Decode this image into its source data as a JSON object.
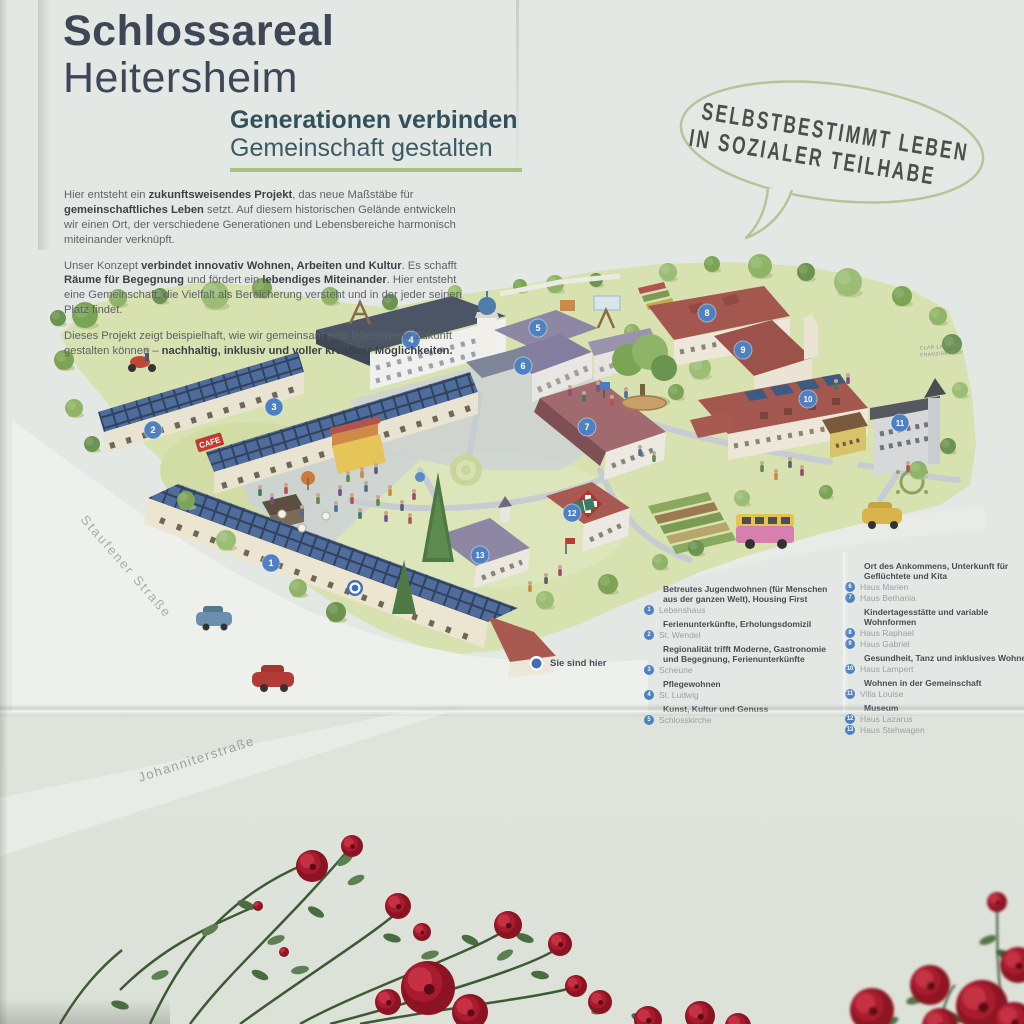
{
  "banner": {
    "title_line1": "Schlossareal",
    "title_line2": "Heitersheim",
    "subtitle_line1": "Generationen verbinden",
    "subtitle_line2": "Gemeinschaft gestalten",
    "bubble_line1": "SELBSTBESTIMMT LEBEN",
    "bubble_line2": "IN SOZIALER TEILHABE"
  },
  "intro": {
    "p1": {
      "s": [
        {
          "t": "Hier entsteht ein "
        },
        {
          "t": "zukunftsweisendes Projekt",
          "b": true
        },
        {
          "t": ", das neue Maßstäbe für "
        },
        {
          "t": "gemeinschaftliches Leben",
          "b": true
        },
        {
          "t": " setzt. Auf diesem historischen Gelände entwickeln wir einen Ort, der verschiedene Generationen und Lebensbereiche harmonisch miteinander verknüpft."
        }
      ]
    },
    "p2": {
      "s": [
        {
          "t": "Unser Konzept "
        },
        {
          "t": "verbindet innovativ Wohnen, Arbeiten und Kultur",
          "b": true
        },
        {
          "t": ". Es schafft "
        },
        {
          "t": "Räume für Begegnung",
          "b": true
        },
        {
          "t": " und fördert ein "
        },
        {
          "t": "lebendiges Miteinander",
          "b": true
        },
        {
          "t": ". Hier entsteht eine Gemeinschaft, die Vielfalt als Bereicherung versteht und in der jeder seinen Platz findet."
        }
      ]
    },
    "p3": {
      "s": [
        {
          "t": "Dieses Projekt zeigt beispielhaft, wie wir gemeinsam eine lebenswerte Zukunft gestalten können – "
        },
        {
          "t": "nachhaltig, inklusiv und voller kreativer Möglichkeiten.",
          "b": true
        }
      ]
    }
  },
  "map": {
    "cafe_sign": "CAFE",
    "street_left": "Staufener Straße",
    "street_bottom": "Johanniterstraße",
    "signature": "Clar Langen Franziskus",
    "you_are_here_label": "Sie sind hier",
    "markers": [
      {
        "n": "1",
        "x": 271,
        "y": 563
      },
      {
        "n": "2",
        "x": 153,
        "y": 430
      },
      {
        "n": "3",
        "x": 274,
        "y": 407
      },
      {
        "n": "4",
        "x": 411,
        "y": 340
      },
      {
        "n": "5",
        "x": 538,
        "y": 328
      },
      {
        "n": "6",
        "x": 523,
        "y": 366
      },
      {
        "n": "7",
        "x": 587,
        "y": 427
      },
      {
        "n": "8",
        "x": 707,
        "y": 313
      },
      {
        "n": "9",
        "x": 743,
        "y": 350
      },
      {
        "n": "10",
        "x": 808,
        "y": 399
      },
      {
        "n": "11",
        "x": 900,
        "y": 423
      },
      {
        "n": "12",
        "x": 572,
        "y": 513
      },
      {
        "n": "13",
        "x": 480,
        "y": 555
      }
    ],
    "you_are_here_pos": {
      "x": 355,
      "y": 588
    }
  },
  "legend": {
    "left": [
      {
        "title": "Betreutes Jugendwohnen (für Menschen aus der ganzen Welt), Housing First",
        "entries": [
          {
            "n": "1",
            "name": "Lebenshaus"
          }
        ]
      },
      {
        "title": "Ferienunterkünfte, Erholungsdomizil",
        "entries": [
          {
            "n": "2",
            "name": "St. Wendel"
          }
        ]
      },
      {
        "title": "Regionalität trifft Moderne, Gastronomie und Begegnung, Ferienunterkünfte",
        "entries": [
          {
            "n": "3",
            "name": "Scheune"
          }
        ]
      },
      {
        "title": "Pflegewohnen",
        "entries": [
          {
            "n": "4",
            "name": "St. Ludwig"
          }
        ]
      },
      {
        "title": "Kunst, Kultur und Genuss",
        "entries": [
          {
            "n": "5",
            "name": "Schlosskirche"
          }
        ]
      }
    ],
    "right": [
      {
        "title": "Ort des Ankommens, Unterkunft für Geflüchtete und Kita",
        "entries": [
          {
            "n": "6",
            "name": "Haus Marien"
          },
          {
            "n": "7",
            "name": "Haus Bethania"
          }
        ]
      },
      {
        "title": "Kindertagesstätte und variable Wohnformen",
        "entries": [
          {
            "n": "8",
            "name": "Haus Raphael"
          },
          {
            "n": "9",
            "name": "Haus Gabriel"
          }
        ]
      },
      {
        "title": "Gesundheit, Tanz und inklusives Wohnen",
        "entries": [
          {
            "n": "10",
            "name": "Haus Lampert"
          }
        ]
      },
      {
        "title": "Wohnen in der Gemeinschaft",
        "entries": [
          {
            "n": "11",
            "name": "Villa Louise"
          }
        ]
      },
      {
        "title": "Museum",
        "entries": [
          {
            "n": "12",
            "name": "Haus Lazarus"
          },
          {
            "n": "13",
            "name": "Haus Stehwagen"
          }
        ]
      }
    ]
  },
  "colors": {
    "marker_blue": "#4d81c2",
    "accent_green": "#a9c17c",
    "bubble_green": "#b7c49a",
    "title_dark": "#3d4757",
    "subtitle_teal": "#33515d",
    "rose_red": "#a81b2e"
  }
}
